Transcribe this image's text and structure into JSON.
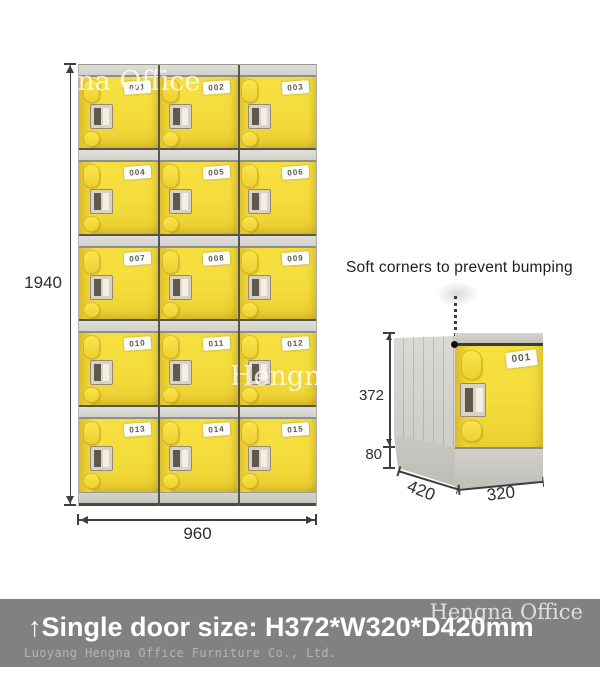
{
  "watermarks": {
    "top": "Hengna Office",
    "middle": "Hengna Office"
  },
  "cabinet": {
    "doors": [
      "001",
      "002",
      "003",
      "004",
      "005",
      "006",
      "007",
      "008",
      "009",
      "010",
      "011",
      "012",
      "013",
      "014",
      "015"
    ],
    "height_label": "1940",
    "width_label": "960"
  },
  "single_locker": {
    "caption": "Soft corners to prevent bumping",
    "door_number": "001",
    "door_height_label": "372",
    "base_height_label": "80",
    "depth_label": "420",
    "width_label": "320"
  },
  "banner": {
    "watermark": "Hengna Office",
    "title": "↑Single door size: H372*W320*D420mm",
    "subtitle": "Luoyang Hengna Office Furniture Co., Ltd."
  },
  "colors": {
    "door_yellow": "#f4dc3c",
    "frame_gray": "#d9d8d3",
    "banner_gray": "#818181",
    "dimension_text": "#2f2f2f"
  }
}
